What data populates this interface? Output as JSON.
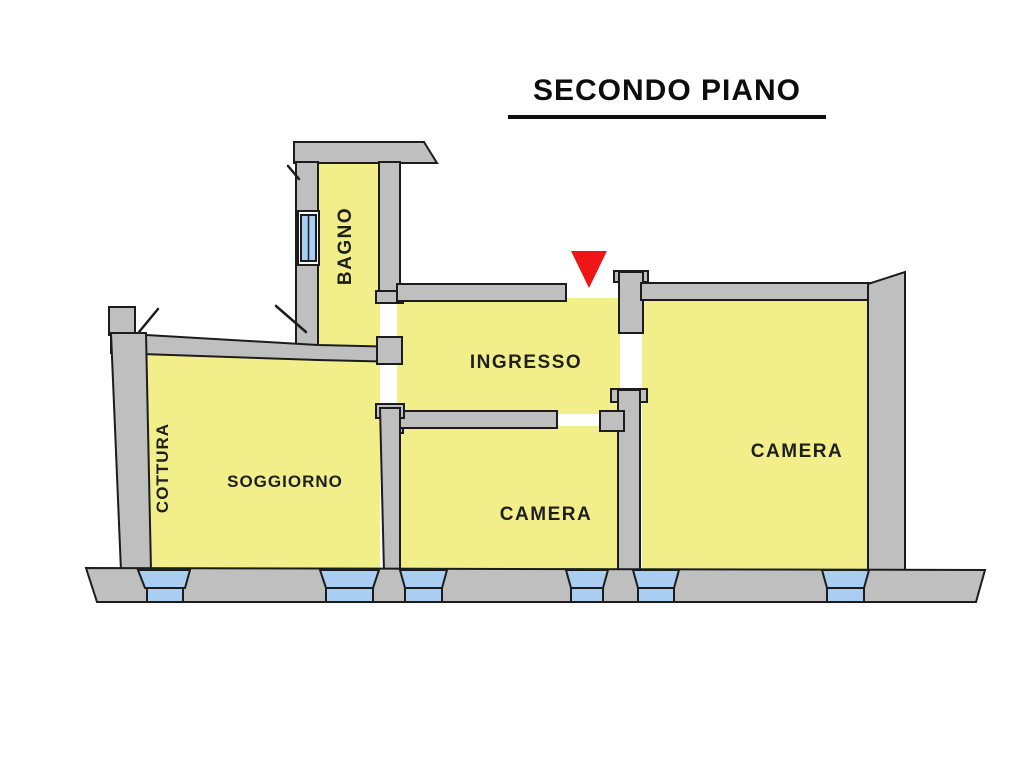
{
  "title": {
    "text": "SECONDO PIANO"
  },
  "floor_plan": {
    "rooms": [
      {
        "label": "BAGNO",
        "orientation": "vertical"
      },
      {
        "label": "INGRESSO",
        "orientation": "horizontal"
      },
      {
        "label": "COTTURA",
        "orientation": "vertical"
      },
      {
        "label": "SOGGIORNO",
        "orientation": "horizontal"
      },
      {
        "label": "CAMERA",
        "orientation": "horizontal"
      },
      {
        "label": "CAMERA",
        "orientation": "horizontal"
      }
    ],
    "entrance_marker": {
      "shape": "triangle-down",
      "color": "#ed1515"
    },
    "colors": {
      "page_bg": "#ffffff",
      "room_fill": "#f2ef8b",
      "wall_fill": "#bfbfbf",
      "window_fill": "#aacdf2",
      "outline": "#1c1c1c",
      "label": "#1f1f1f",
      "marker": "#ed1515",
      "title": "#0d0d0d"
    }
  }
}
